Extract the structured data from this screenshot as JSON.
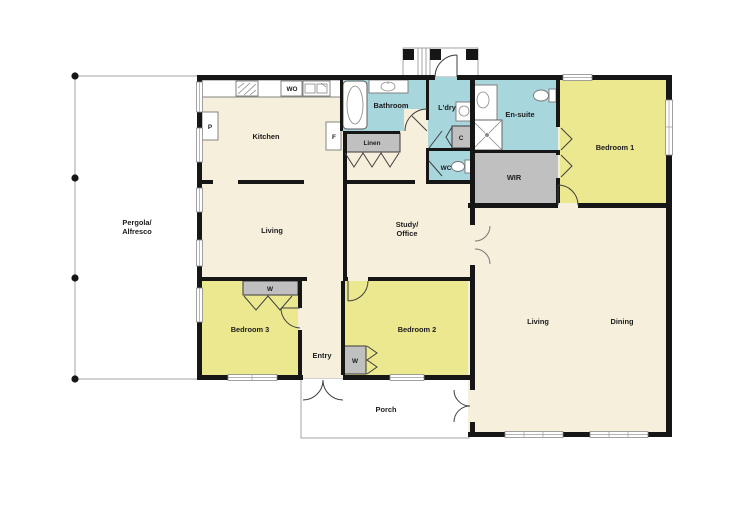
{
  "floorplan": {
    "labels": {
      "pergola_line1": "Pergola/",
      "pergola_line2": "Alfresco",
      "kitchen": "Kitchen",
      "wo": "WO",
      "p": "P",
      "f": "F",
      "bathroom": "Bathroom",
      "linen": "Linen",
      "ldry": "L'dry",
      "c": "C",
      "wc": "WC",
      "ensuite": "En-suite",
      "wir": "WIR",
      "bedroom1": "Bedroom 1",
      "living_front": "Living",
      "study_line1": "Study/",
      "study_line2": "Office",
      "bedroom3": "Bedroom 3",
      "w": "W",
      "entry": "Entry",
      "bedroom2": "Bedroom 2",
      "living_rear": "Living",
      "dining": "Dining",
      "porch": "Porch"
    },
    "colors": {
      "floor": "#f5efdb",
      "bedroom": "#ece88f",
      "wet": "#a8d6dd",
      "storage": "#c0c0c0",
      "wall": "#161616",
      "outline": "#9a9a9a"
    }
  }
}
